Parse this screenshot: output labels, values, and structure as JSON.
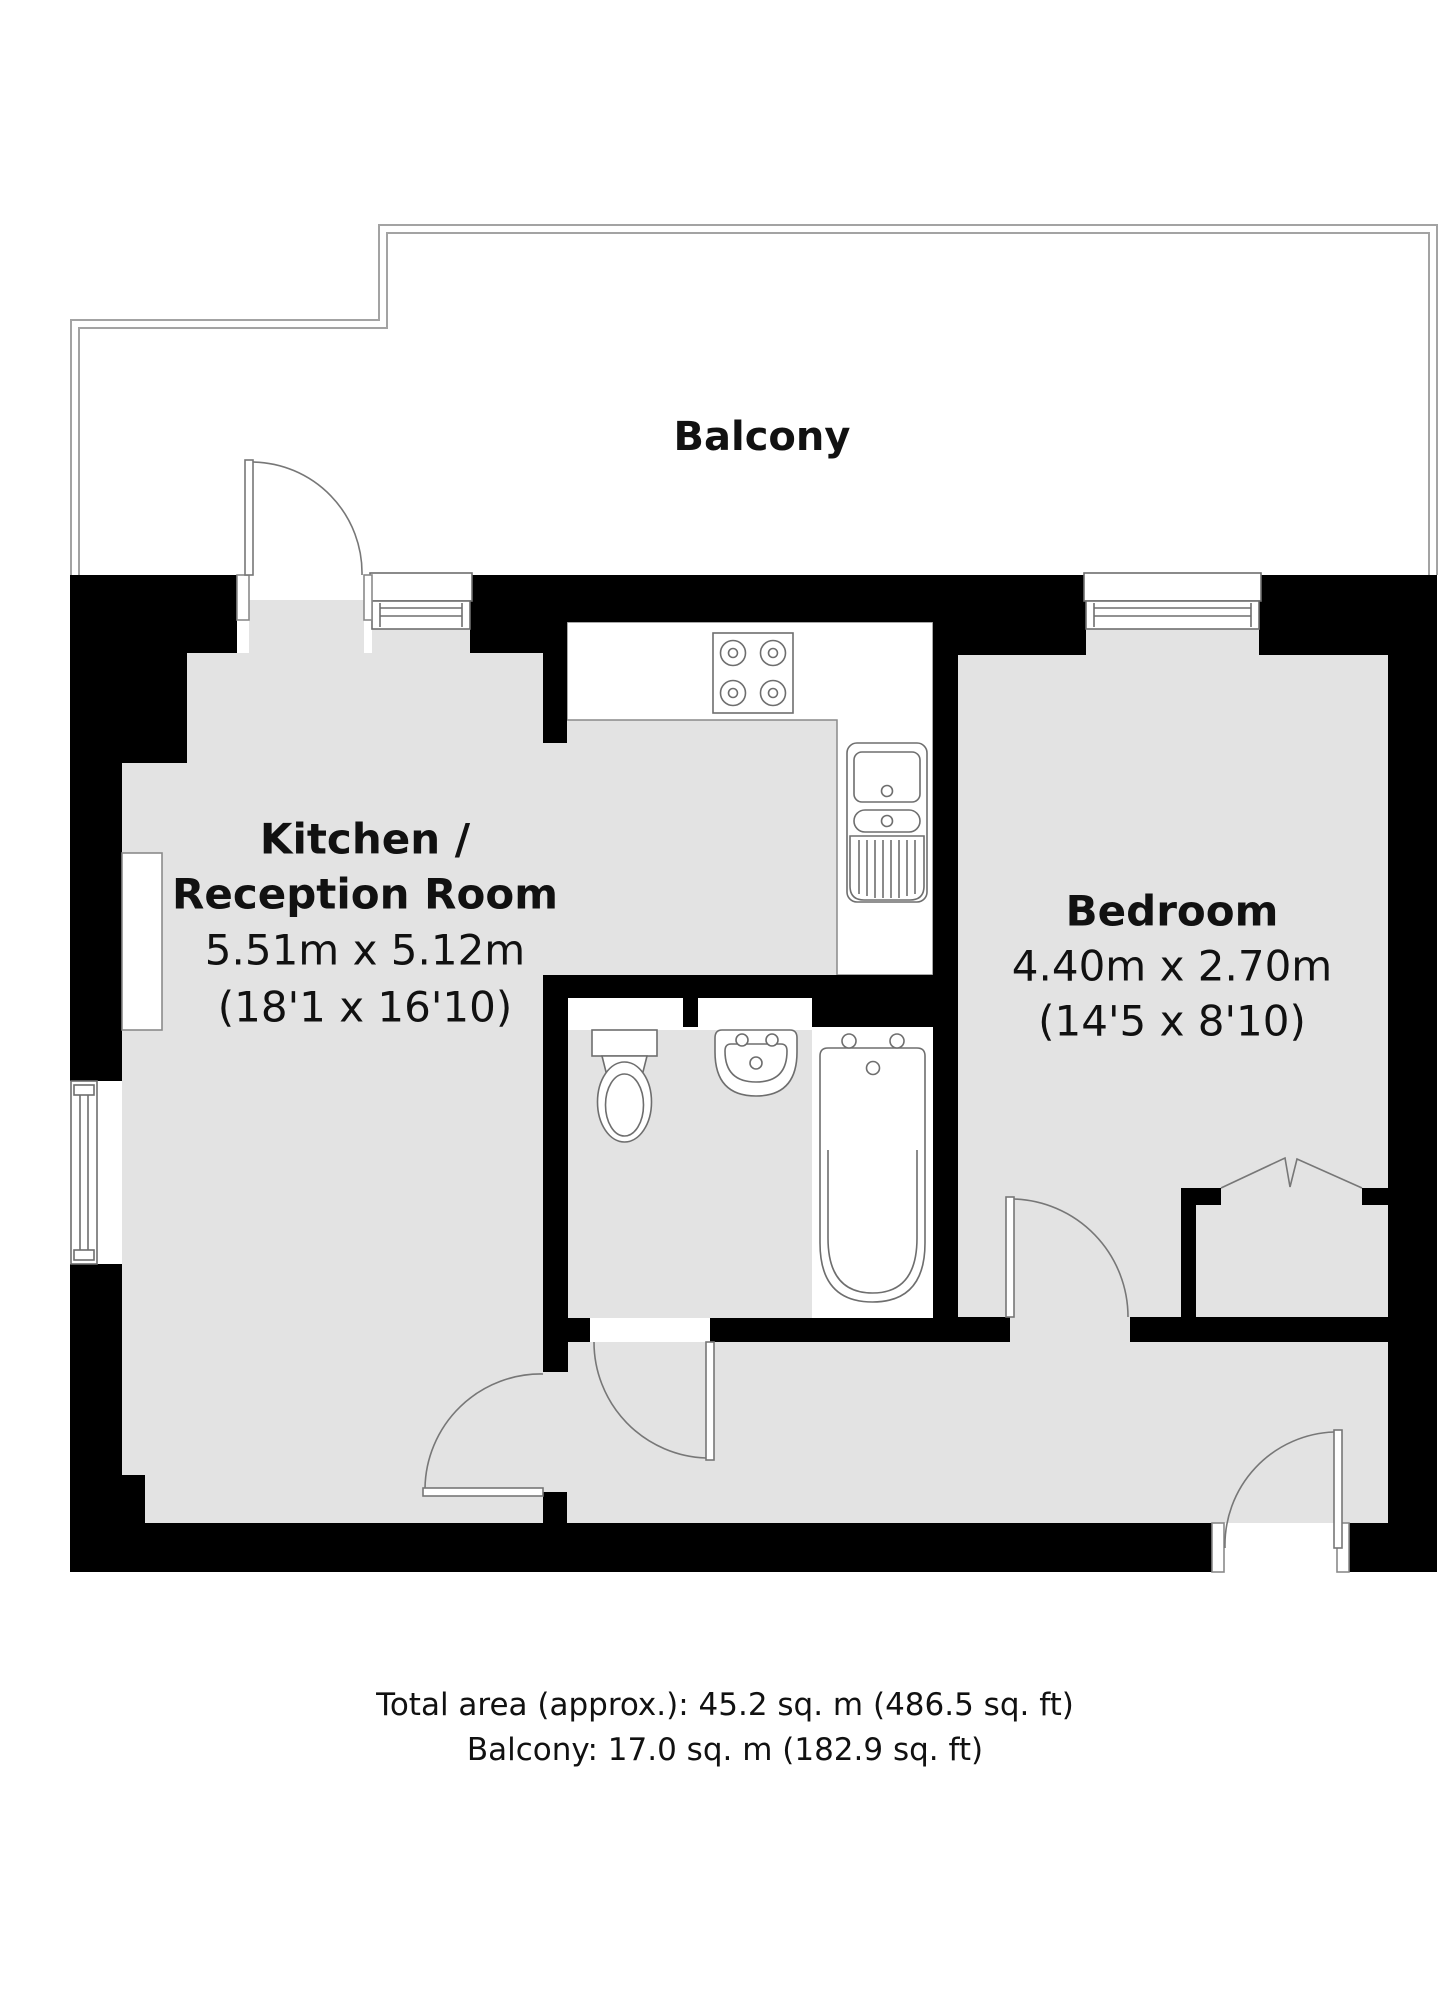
{
  "plan": {
    "balcony_label": "Balcony",
    "kitchen": {
      "title_line1": "Kitchen /",
      "title_line2": "Reception Room",
      "metric": "5.51m x 5.12m",
      "imperial": "(18'1 x 16'10)"
    },
    "bedroom": {
      "title": "Bedroom",
      "metric": "4.40m x 2.70m",
      "imperial": "(14'5 x 8'10)"
    },
    "summary": {
      "total_area": "Total area (approx.): 45.2 sq. m (486.5 sq. ft)",
      "balcony_area": "Balcony: 17.0 sq. m (182.9 sq. ft)"
    },
    "colors": {
      "wall": "#000000",
      "floor": "#e3e3e3",
      "fixture_line": "#6e6e6e",
      "door_line": "#777777",
      "balcony_line": "#a3a3a3",
      "text": "#111111"
    }
  }
}
